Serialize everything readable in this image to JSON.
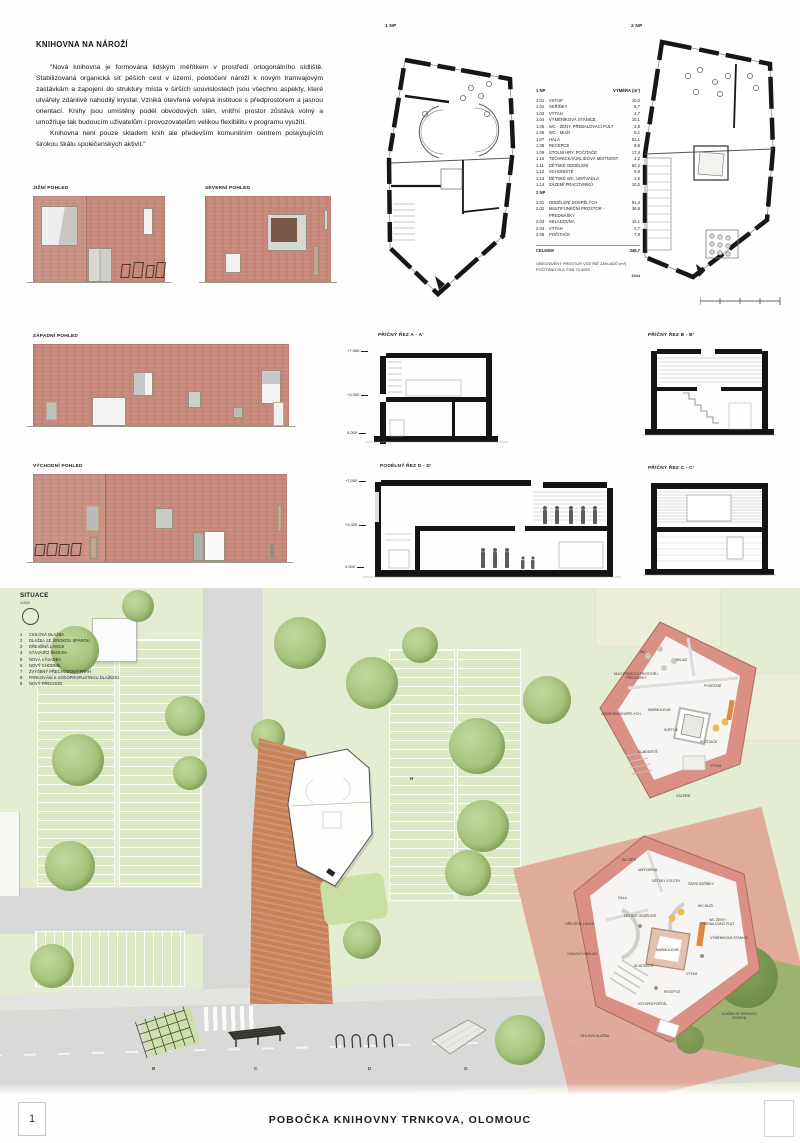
{
  "intro": {
    "title": "KNIHOVNA NA NÁROŽÍ",
    "para1": "\"Nová knihovna je formována lidským měřítkem v prostředí ortogonálního sídliště. Stabilizovaná organická síť pěších cest v území, pootočení nároží k novým tramvajovým zastávkám a zapojení do struktury místa v širších souvislostech jsou všechno aspekty, které utvářely zdánlivě nahodilý krystal. Vzniká otevřená veřejná instituce s předprostorem a jasnou orientací. Knihy jsou umístěny podél obvodových stěn, vnitřní prostor zůstává volný a umožňuje tak budoucím uživatelům i provozovatelům velikou flexibilitu v programu využití.",
    "para2": "Knihovna není pouze skladem knih ale především komunitním centrem poskytujícím širokou škálu společenských aktivit.\""
  },
  "plans": {
    "plan1_label": "1 NP",
    "plan2_label": "2 NP",
    "legend1_title": "1 NP",
    "legend1_area": "VÝMĚRA (m²)",
    "legend1": [
      {
        "num": "1.01",
        "name": "VSTUP",
        "area": "10,0"
      },
      {
        "num": "1.02",
        "name": "SKŘÍŇKY",
        "area": "6,7"
      },
      {
        "num": "1.03",
        "name": "VÝTAH",
        "area": "2,7"
      },
      {
        "num": "1.04",
        "name": "VÝMĚNÍKOVÁ STANICE",
        "area": "10,1"
      },
      {
        "num": "1.05",
        "name": "WC - ŽENY, PŘEBALOVACÍ PULT",
        "area": "3,8"
      },
      {
        "num": "1.06",
        "name": "WC - MUŽI",
        "area": "5,1"
      },
      {
        "num": "1.07",
        "name": "HALA",
        "area": "52,1"
      },
      {
        "num": "1.08",
        "name": "RECEPCE",
        "area": "9,8"
      },
      {
        "num": "1.09",
        "name": "STOLNÍ HRY, POČÍTAČE",
        "area": "17,4"
      },
      {
        "num": "1.10",
        "name": "TECHNICKÁ/ÚKLIDOVÁ MÍSTNOST",
        "area": "4,2"
      },
      {
        "num": "1.11",
        "name": "DĚTSKÉ ODDĚLENÍ",
        "area": "62,2"
      },
      {
        "num": "1.12",
        "name": "SCHODIŠTĚ",
        "area": "9,9"
      },
      {
        "num": "1.13",
        "name": "DĚTSKÉ WC, UMÝVADLA",
        "area": "1,5"
      },
      {
        "num": "1.14",
        "name": "ZÁZEMÍ PRACOVNÍKŮ",
        "area": "10,0"
      }
    ],
    "legend2_title": "2 NP",
    "legend2": [
      {
        "num": "2.01",
        "name": "ODDĚLENÍ DOSPĚLÝCH",
        "area": "91,3"
      },
      {
        "num": "2.02",
        "name": "MULTIFUNKČNÍ PROSTOR - PŘEDNÁŠKY",
        "area": "36,8"
      },
      {
        "num": "2.03",
        "name": "SKLADOVNA",
        "area": "10,1"
      },
      {
        "num": "2.04",
        "name": "VÝTAH",
        "area": "2,7"
      },
      {
        "num": "2.05",
        "name": "POČÍTAČE",
        "area": "7,8"
      }
    ],
    "total_label": "CELKEM",
    "total_value": "349,7",
    "note_line1": "OBESTAVĚNÝ PROSTOR VČETNĚ ZÁKLADŮ (m³)",
    "note_line2": "POČÍTÁNO DLE ČSN 73-4055",
    "note_value": "1544"
  },
  "elevations": {
    "south": "JIŽNÍ POHLED",
    "north": "SEVERNÍ POHLED",
    "west": "ZÁPADNÍ POHLED",
    "east": "VÝCHODNÍ POHLED"
  },
  "sections": {
    "a": "PŘÍČNÝ ŘEZ A - A'",
    "b": "PŘÍČNÝ ŘEZ B - B'",
    "d": "PODÉLNÝ ŘEZ D - D'",
    "c": "PŘÍČNÝ ŘEZ C - C'",
    "levels": [
      "+7,050",
      "+3,300",
      "0,000"
    ]
  },
  "site": {
    "title": "SITUACE",
    "scale": "1:200",
    "legend": [
      {
        "num": "1",
        "name": "CIHLOVÁ DLAŽBA"
      },
      {
        "num": "2",
        "name": "DLAŽBA SE ŠIROKOU SPÁROU"
      },
      {
        "num": "3",
        "name": "DŘEVĚNÁ LAVICE"
      },
      {
        "num": "4",
        "name": "STÁVAJÍCÍ ŠKOLKA"
      },
      {
        "num": "5",
        "name": "NOVÁ VÝSADBA"
      },
      {
        "num": "6",
        "name": "NOVÝ CHODNÍK"
      },
      {
        "num": "7",
        "name": "ZVÝŠENÝ PŘECHODOVÝ PRÁH"
      },
      {
        "num": "8",
        "name": "PARKOVÁNÍ S VODOPROPUSTNOU DLAŽBOU"
      },
      {
        "num": "9",
        "name": "NOVÝ PŘECHOD"
      }
    ],
    "parking_label": "H",
    "details": [
      "B",
      "C",
      "D",
      "G"
    ]
  },
  "axon_upper": {
    "labels": [
      "WC",
      "SKLAD",
      "MULTIFUNKČNÍ PROSTOR / PŘEDNÁŠKY",
      "ODDĚLENÍ DOSPĚLÝCH",
      "POSEZENÍ",
      "SVĚTLÍK",
      "SCHODIŠTĚ",
      "POČÍTAČE",
      "VÝTAH",
      "GALERIE",
      "MARMOLEUM"
    ]
  },
  "axon_lower": {
    "labels": [
      "WC DĚTI",
      "UMÝVÁRNA",
      "DĚTSKÝ KOUTEK",
      "ŠATNÍ SKŘÍŇKY",
      "HALA",
      "DĚTSKÉ ODDĚLENÍ",
      "WC MUŽI",
      "WC ŽENY / PŘEBALOVACÍ PULT",
      "VÝMĚNÍKOVÁ STANICE",
      "MARMOLEUM",
      "SCHODIŠTĚ",
      "VÝTAH",
      "RECEPCE",
      "DŘEVĚNÁ LAVICE",
      "CIHLOVÝ OBKLAD",
      "VSTUPNÍ PORTÁL",
      "CIHLOVÁ DLAŽBA",
      "DLAŽBA SE ŠIROKOU SPÁROU"
    ]
  },
  "footer": {
    "page": "1",
    "title": "POBOČKA KNIHOVNY TRNKOVA, OLOMOUC"
  },
  "colors": {
    "brick": "#c6897c",
    "plaza": "#c8825a",
    "lawn": "#e4ecd2",
    "road": "#d9dad7",
    "axon_wall": "#da9085",
    "accent_orange": "#de8a3a",
    "accent_yellow": "#e6bf4e"
  }
}
